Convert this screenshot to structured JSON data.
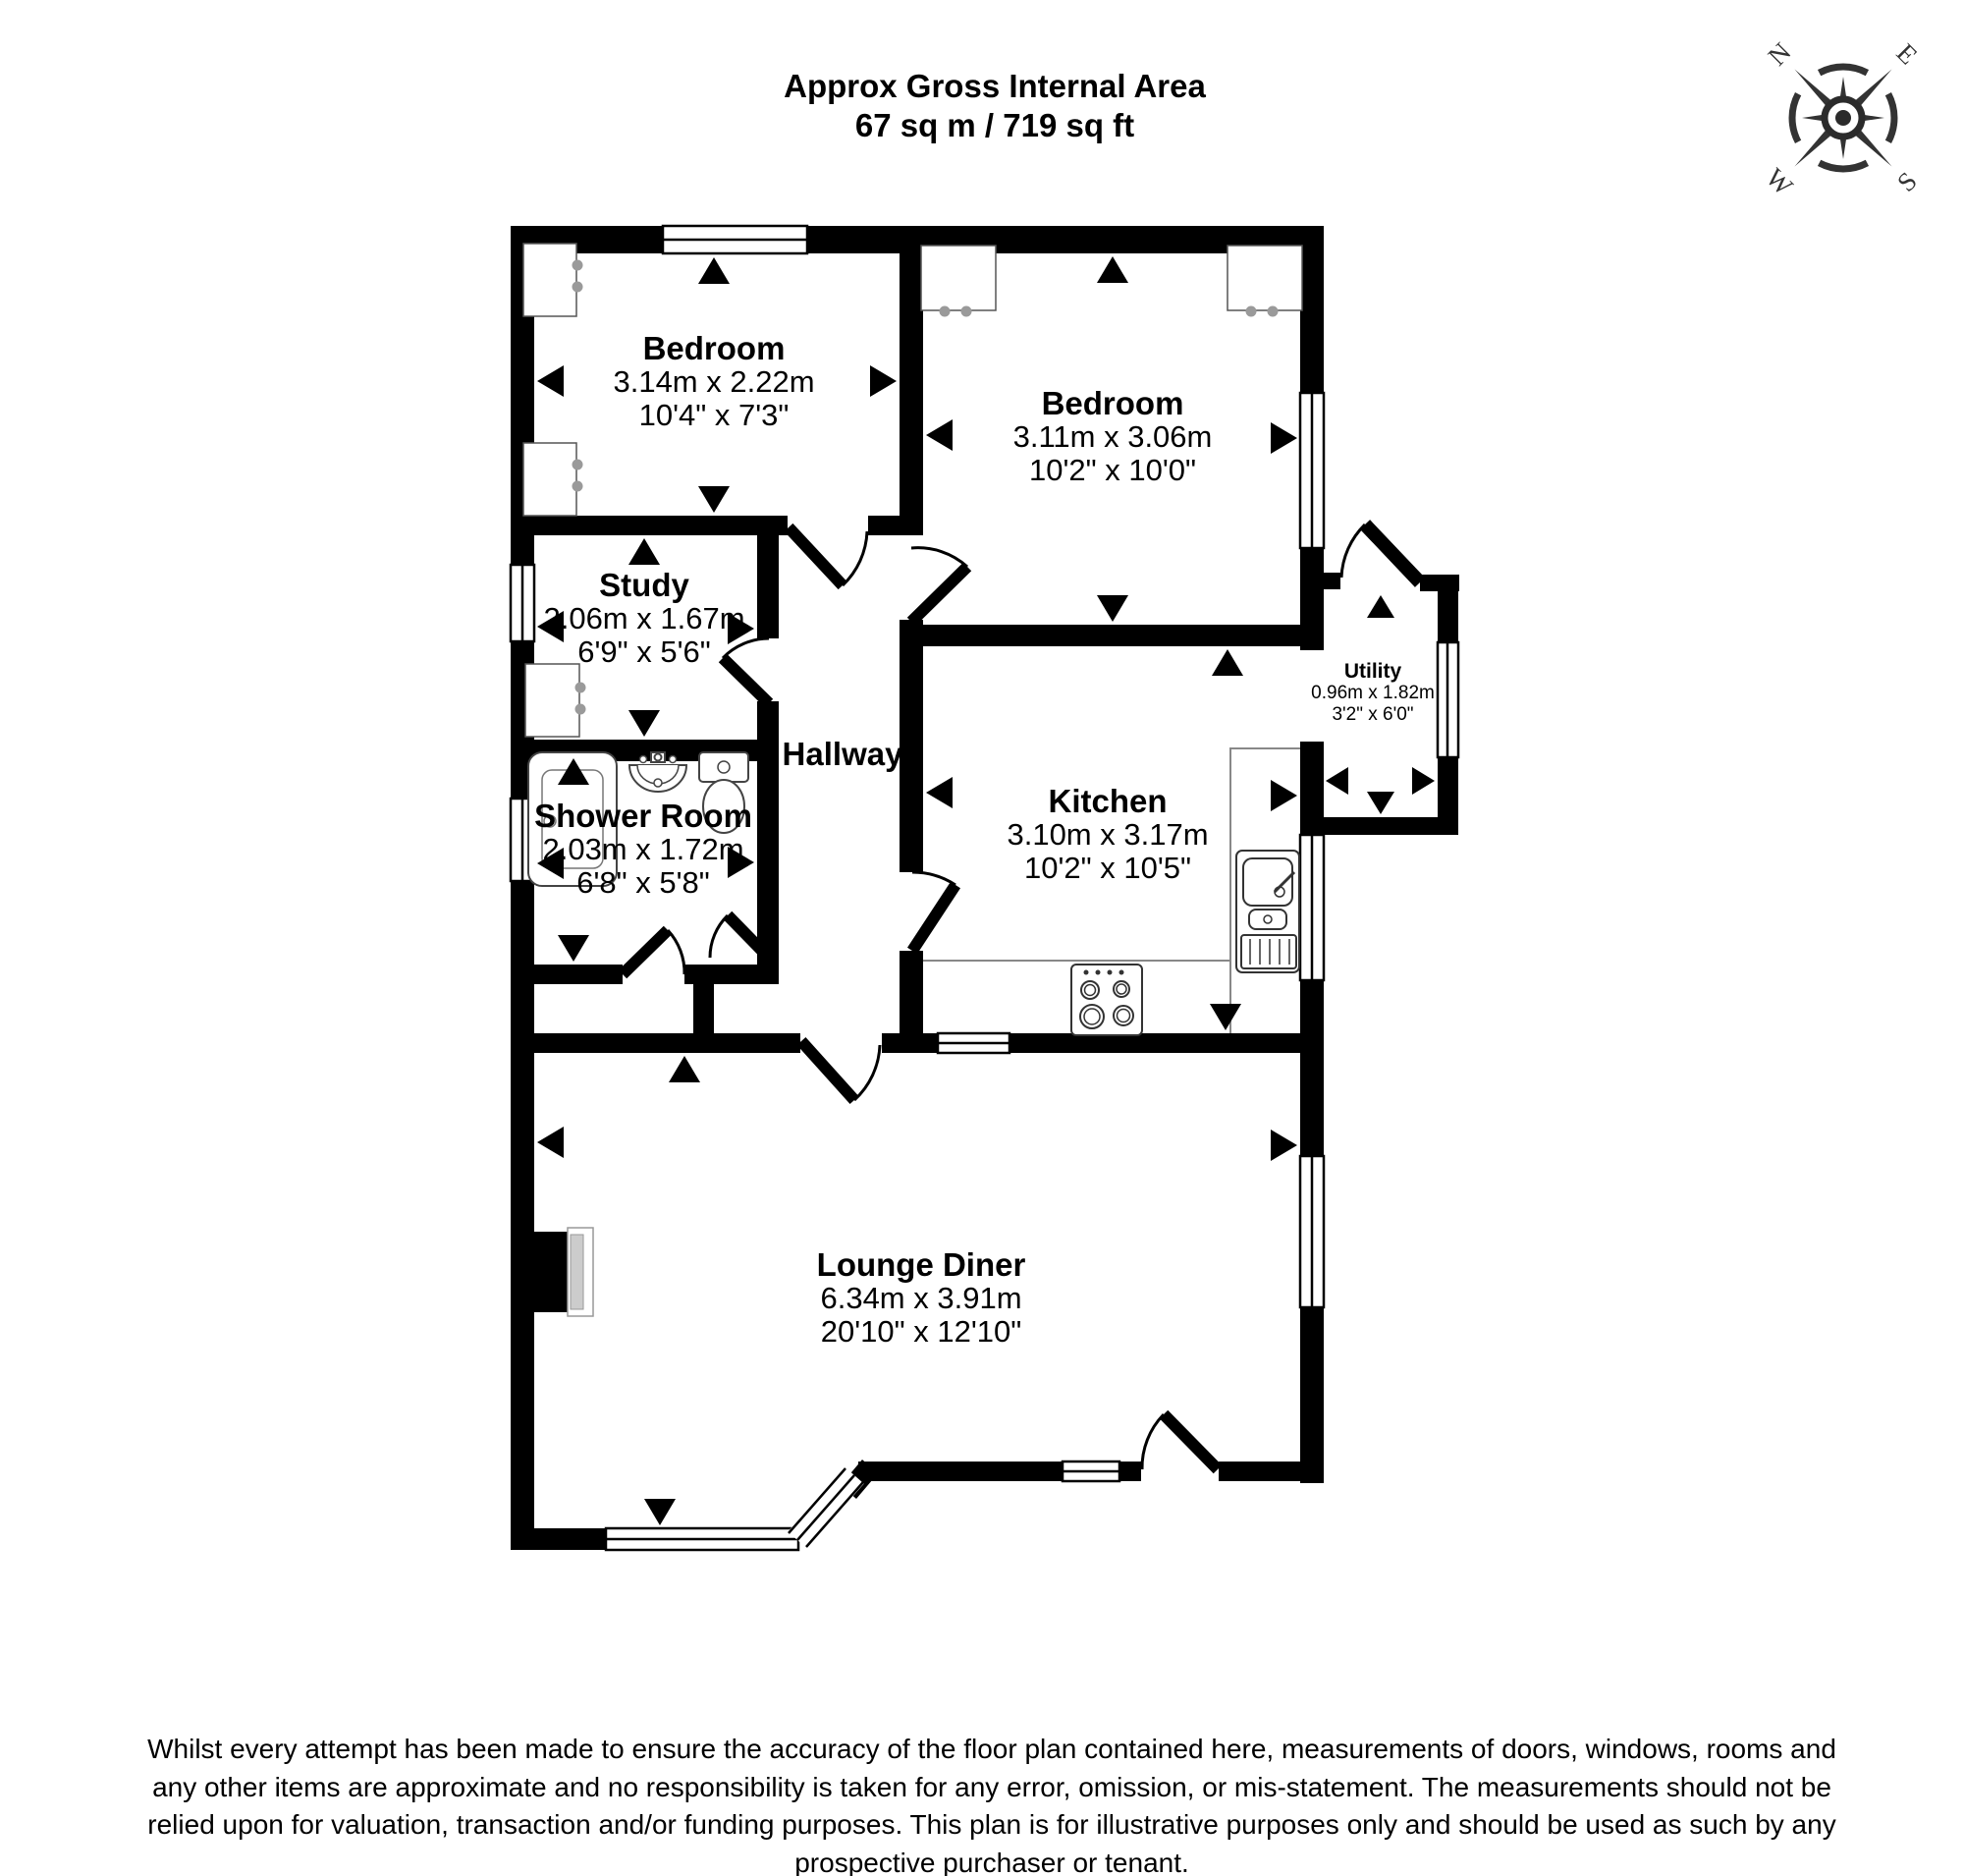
{
  "header": {
    "line1": "Approx Gross Internal Area",
    "line2": "67 sq m / 719 sq ft"
  },
  "compass": {
    "n": "N",
    "e": "E",
    "s": "S",
    "w": "W"
  },
  "rooms": {
    "bedroom1": {
      "name": "Bedroom",
      "metric": "3.14m x 2.22m",
      "imperial": "10'4\" x 7'3\""
    },
    "bedroom2": {
      "name": "Bedroom",
      "metric": "3.11m x 3.06m",
      "imperial": "10'2\" x 10'0\""
    },
    "study": {
      "name": "Study",
      "metric": "2.06m x 1.67m",
      "imperial": "6'9\" x 5'6\""
    },
    "hallway": {
      "name": "Hallway"
    },
    "shower": {
      "name": "Shower Room",
      "metric": "2.03m x 1.72m",
      "imperial": "6'8\" x 5'8\""
    },
    "kitchen": {
      "name": "Kitchen",
      "metric": "3.10m x 3.17m",
      "imperial": "10'2\" x 10'5\""
    },
    "utility": {
      "name": "Utility",
      "metric": "0.96m x 1.82m",
      "imperial": "3'2\" x 6'0\""
    },
    "lounge": {
      "name": "Lounge Diner",
      "metric": "6.34m x 3.91m",
      "imperial": "20'10\" x 12'10\""
    }
  },
  "disclaimer": {
    "lines": [
      "Whilst every attempt has been made to ensure the accuracy of the floor plan contained here, measurements of doors, windows, rooms and",
      "any other items are approximate and no responsibility is taken for any error, omission, or mis-statement. The measurements should not be",
      "relied upon for valuation, transaction and/or funding purposes. This plan is for illustrative purposes only and should be used as such by any",
      "prospective purchaser or tenant."
    ]
  },
  "colors": {
    "walls": "#000000",
    "text": "#000000",
    "compass": "#333333",
    "fixture_outline": "#444444",
    "handles": "#9a9a9a",
    "counter_outline": "#888888"
  }
}
